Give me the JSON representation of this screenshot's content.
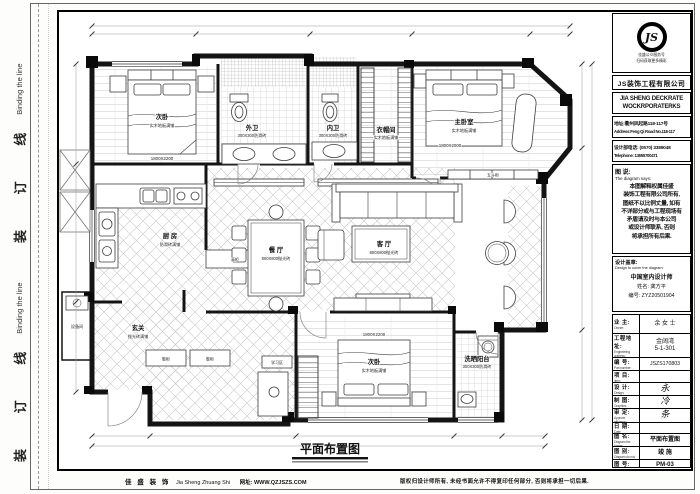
{
  "colors": {
    "paper": "#fdfdfb",
    "ink": "#111111"
  },
  "page": {
    "binding_line": {
      "zh": "装 订 线",
      "en": "Binding the line"
    },
    "drawing_title": "平面布置图",
    "footer": {
      "company_zh": "佳 盛 装 饰",
      "company_en": "Jia Sheng Zhuang Shi",
      "website": "网址: WWW.QZJSZS.COM",
      "copyright": "版权归设计师所有, 未经书面允许不得复印任何部分, 否则将承担一切后果."
    }
  },
  "title_block": {
    "logo": {
      "monogram": "JS",
      "caption1": "佳盛公众服务号",
      "caption2": "扫码获取更多精彩",
      "company_zh": "JS装饰工程有限公司",
      "company_en1": "JIA SHENG DECKRATE",
      "company_en2": "WOCKRPORATERKS"
    },
    "address_zh": "地址:衢州凤起路118-117号",
    "address_en": "Address:Feng Qi Road No.118-117",
    "phone_zh": "设计部电话: (0570) 3389048",
    "phone_en": "Telephone: 13655700471",
    "diagram_says": {
      "label_zh": "图 说:",
      "label_en": "The diagram says:",
      "line1": "本图解释权属佳盛",
      "line2": "装饰工程有限公司所有,",
      "line3": "图纸不以比例丈量, 如有",
      "line4": "不详部分或与工程现场有",
      "line5": "矛盾请及时与本公司",
      "line6": "或设计师联系, 否则",
      "line7": "将承担所有后果."
    },
    "stamp": {
      "label_zh": "设计盖章:",
      "label_en": "Design to cover the diagram:",
      "cert": "中国室内设计师",
      "name": "姓名: 龚方平",
      "number": "编号: ZYZ20501904"
    },
    "fields": [
      {
        "zh": "业 主:",
        "en": "Owner:",
        "value": "余 女 士"
      },
      {
        "zh": "工程地址:",
        "en": "Engineering address:",
        "value": "金阔湾",
        "value2": "5-1-301"
      },
      {
        "zh": "编 号:",
        "en": "Part number:",
        "value": "JSZS170803"
      },
      {
        "zh": "项 目:",
        "en": "Item:",
        "value": ""
      },
      {
        "zh": "设 计:",
        "en": "Design:",
        "value": "永"
      },
      {
        "zh": "制 图:",
        "en": "Graphics:",
        "value": "冷"
      },
      {
        "zh": "审 定:",
        "en": "Approve efficiency:",
        "value": "条"
      },
      {
        "zh": "日 期:",
        "en": "Date:",
        "value": ""
      },
      {
        "zh": "图 名:",
        "en": "Diagram the Name:",
        "value": "平面布置图"
      },
      {
        "zh": "图 别:",
        "en": "Diagram do not:",
        "value": "竣 施"
      },
      {
        "zh": "图 号:",
        "en": "Diagram number:",
        "value": "PM-03"
      }
    ]
  },
  "floor_plan": {
    "rooms": [
      {
        "name": "次卧",
        "material": "实木地板满铺",
        "dim": "1800X2200"
      },
      {
        "name": "外卫",
        "material": "300X300防滑砖"
      },
      {
        "name": "内卫",
        "material": "300X300防滑砖"
      },
      {
        "name": "衣帽间",
        "material": "实木地板满铺"
      },
      {
        "name": "主卧室",
        "material": "实木地板满铺",
        "dim": "1800X2000"
      },
      {
        "name": "厨 房",
        "material": "防滑砖满铺"
      },
      {
        "name": "餐 厅",
        "material": "800X800抛光砖"
      },
      {
        "name": "客 厅",
        "material": "800X800抛光砖"
      },
      {
        "name": "玄关",
        "material": "抛光砖满铺"
      },
      {
        "name": "设备间"
      },
      {
        "name": "学习区"
      },
      {
        "name": "次卧",
        "material": "实木地板满铺",
        "dim": "1800X2200"
      },
      {
        "name": "洗晒阳台",
        "material": "300X300防滑砖"
      }
    ],
    "furniture": {
      "wudougui": "五斗柜",
      "xiegui": "鞋柜",
      "gaogui": "高柜"
    }
  }
}
